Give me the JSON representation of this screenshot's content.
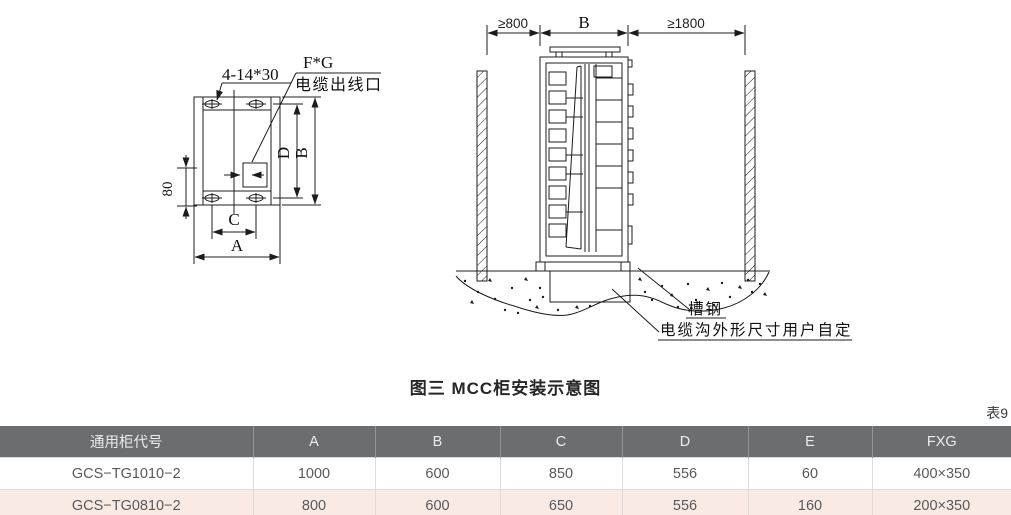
{
  "diagram": {
    "plan": {
      "holes_label": "4-14*30",
      "fg_label": "F*G",
      "outlet_label": "电缆出线口",
      "dim_d": "D",
      "dim_b": "B",
      "dim_c": "C",
      "dim_a": "A",
      "dim_80": "80"
    },
    "side": {
      "left_gap": "≥800",
      "width_label": "B",
      "right_gap": "≥1800",
      "channel_label": "槽钢",
      "trench_label": "电缆沟外形尺寸用户自定"
    }
  },
  "caption": "图三  MCC柜安装示意图",
  "table": {
    "note": "表9",
    "headers": [
      "通用柜代号",
      "A",
      "B",
      "C",
      "D",
      "E",
      "FXG"
    ],
    "rows": [
      [
        "GCS−TG1010−2",
        "1000",
        "600",
        "850",
        "556",
        "60",
        "400×350"
      ],
      [
        "GCS−TG0810−2",
        "800",
        "600",
        "650",
        "556",
        "160",
        "200×350"
      ]
    ],
    "colors": {
      "header_bg": "#6a6e71",
      "alt_row_bg": "#faeae4",
      "line_color": "#1c1c1c"
    }
  }
}
